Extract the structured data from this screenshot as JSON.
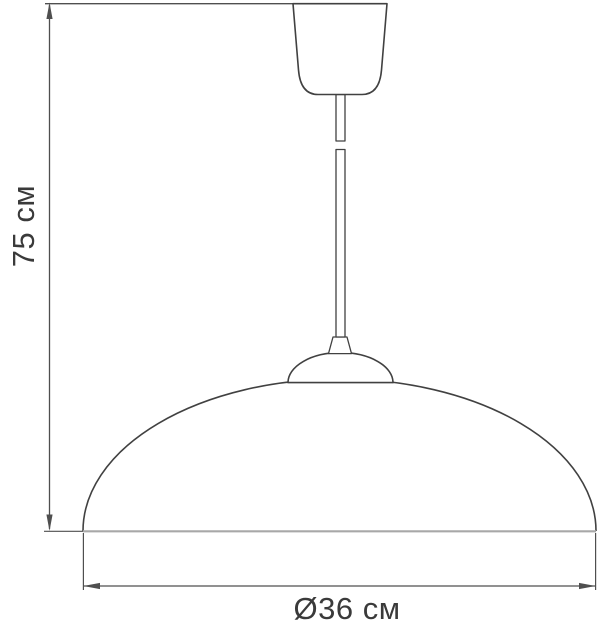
{
  "dimensions": {
    "height": {
      "label": "75 см",
      "value_cm": 75
    },
    "diameter": {
      "label": "Ø36 см",
      "value_cm": 36
    }
  },
  "colors": {
    "line": "#414141",
    "dim_line": "#4f4f4f",
    "base_line": "#a8a8a8",
    "text": "#3a3a3a",
    "background": "#ffffff"
  }
}
